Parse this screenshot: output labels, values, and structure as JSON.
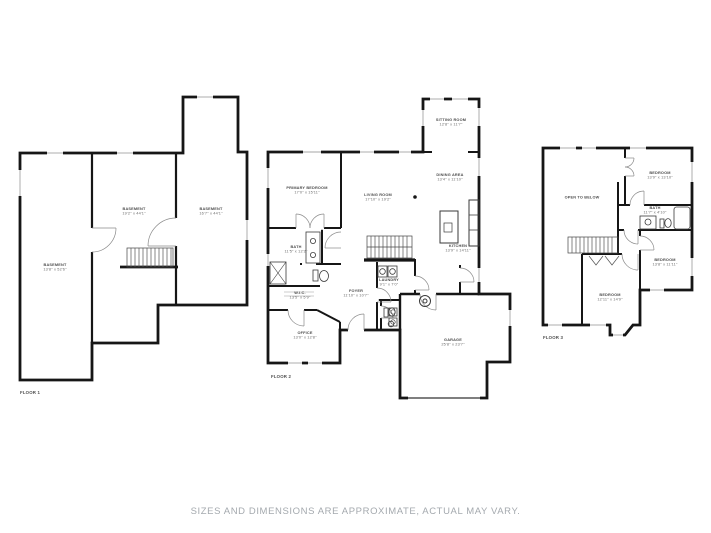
{
  "disclaimer": "SIZES AND DIMENSIONS ARE APPROXIMATE, ACTUAL MAY VARY.",
  "colors": {
    "background": "#ffffff",
    "wall": "#161616",
    "window": "#c4c4c4",
    "fixture": "#3a3a3a",
    "label_text": "#565656",
    "disclaimer_text": "#a4a9ae"
  },
  "floors": [
    {
      "tag": "FLOOR 1",
      "rooms": [
        {
          "name": "BASEMENT",
          "dims": "13'8\" x 52'6\""
        },
        {
          "name": "BASEMENT",
          "dims": "19'2\" x 44'1\""
        },
        {
          "name": "BASEMENT",
          "dims": "16'7\" x 44'1\""
        }
      ]
    },
    {
      "tag": "FLOOR 2",
      "rooms": [
        {
          "name": "PRIMARY BEDROOM",
          "dims": "17'0\" x 15'11\""
        },
        {
          "name": "LIVING ROOM",
          "dims": "17'10\" x 19'2\""
        },
        {
          "name": "DINING AREA",
          "dims": "13'4\" x 11'10\""
        },
        {
          "name": "SITTING ROOM",
          "dims": "12'8\" x 11'7\""
        },
        {
          "name": "KITCHEN",
          "dims": "13'9\" x 14'11\""
        },
        {
          "name": "BATH",
          "dims": "11'5\" x 12'2\""
        },
        {
          "name": "W.I.C.",
          "dims": "13'5\" x 5'9\""
        },
        {
          "name": "FOYER",
          "dims": "11'10\" x 10'7\""
        },
        {
          "name": "LAUNDRY",
          "dims": "9'1\" x 7'0\""
        },
        {
          "name": "OFFICE",
          "dims": "13'0\" x 12'8\""
        },
        {
          "name": "GARAGE",
          "dims": "25'8\" x 23'7\""
        }
      ]
    },
    {
      "tag": "FLOOR 3",
      "rooms": [
        {
          "name": "OPEN TO BELOW",
          "dims": ""
        },
        {
          "name": "BEDROOM",
          "dims": "13'9\" x 13'10\""
        },
        {
          "name": "BATH",
          "dims": "11'7\" x 4'10\""
        },
        {
          "name": "BEDROOM",
          "dims": "13'8\" x 11'11\""
        },
        {
          "name": "BEDROOM",
          "dims": "12'11\" x 14'9\""
        }
      ]
    }
  ]
}
